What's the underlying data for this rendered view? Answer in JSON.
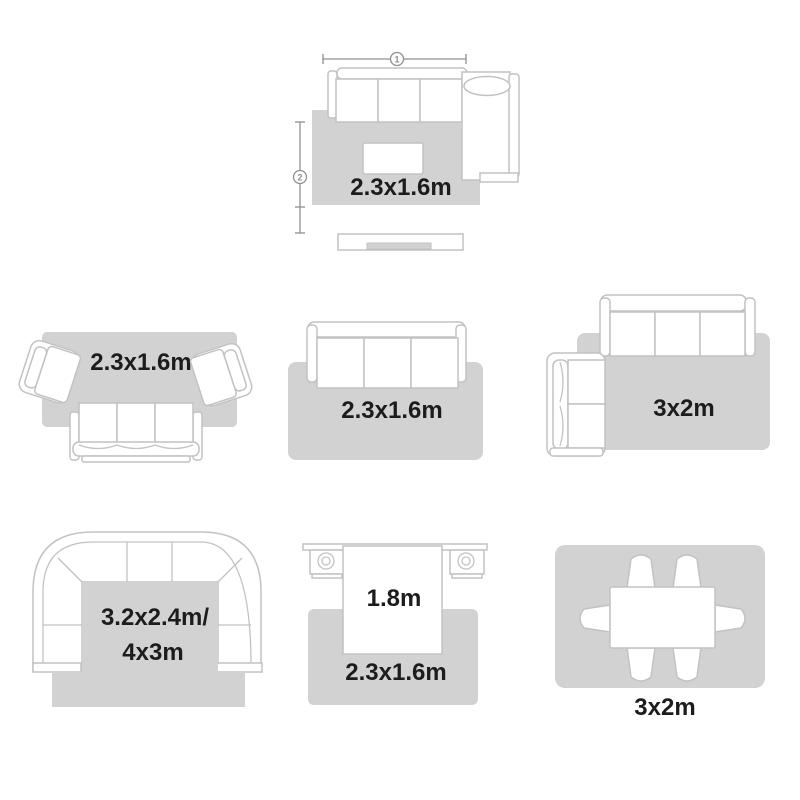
{
  "colors": {
    "rug_fill": "#d2d2d2",
    "furniture_stroke": "#c2c2c2",
    "label_color": "#1c1c1c",
    "dimension_color": "#8f8f8f"
  },
  "dimensions": {
    "width_marker_label": "1",
    "height_marker_label": "2"
  },
  "layouts": {
    "top": {
      "rug_label": "2.3x1.6m"
    },
    "mid_left": {
      "rug_label": "2.3x1.6m"
    },
    "mid_center": {
      "rug_label": "2.3x1.6m"
    },
    "mid_right": {
      "rug_label": "3x2m"
    },
    "bottom_left": {
      "rug_label_line1": "3.2x2.4m/",
      "rug_label_line2": "4x3m"
    },
    "bottom_center": {
      "bed_width_label": "1.8m",
      "rug_label": "2.3x1.6m"
    },
    "bottom_right": {
      "rug_label": "3x2m"
    }
  }
}
